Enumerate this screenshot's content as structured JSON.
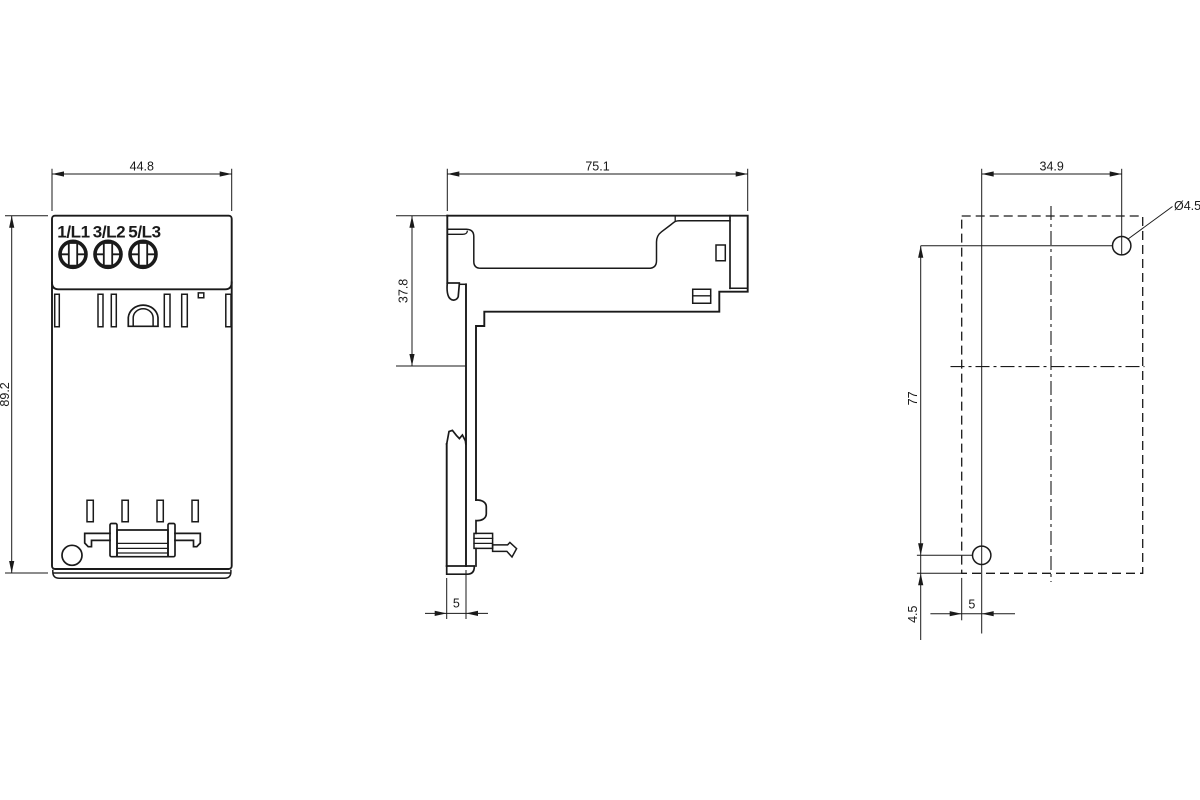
{
  "drawing": {
    "type": "technical-dimension-drawing",
    "units_scale_px_per_mm": 4,
    "colors": {
      "line": "#1a1a1a",
      "background": "#ffffff"
    },
    "front_view": {
      "width_dim": "44.8",
      "height_dim": "89.2",
      "terminal_labels": [
        "1/L1",
        "3/L2",
        "5/L3"
      ]
    },
    "side_view": {
      "width_dim": "75.1",
      "upper_depth_dim": "37.8",
      "rail_plate_dim": "5"
    },
    "drilling_plan": {
      "horizontal_hole_spacing_dim": "34.9",
      "vertical_hole_spacing_dim": "77",
      "hole_diameter_label": "Ø4.5",
      "bottom_offset_dim": "4.5",
      "left_offset_dim": "5"
    }
  }
}
